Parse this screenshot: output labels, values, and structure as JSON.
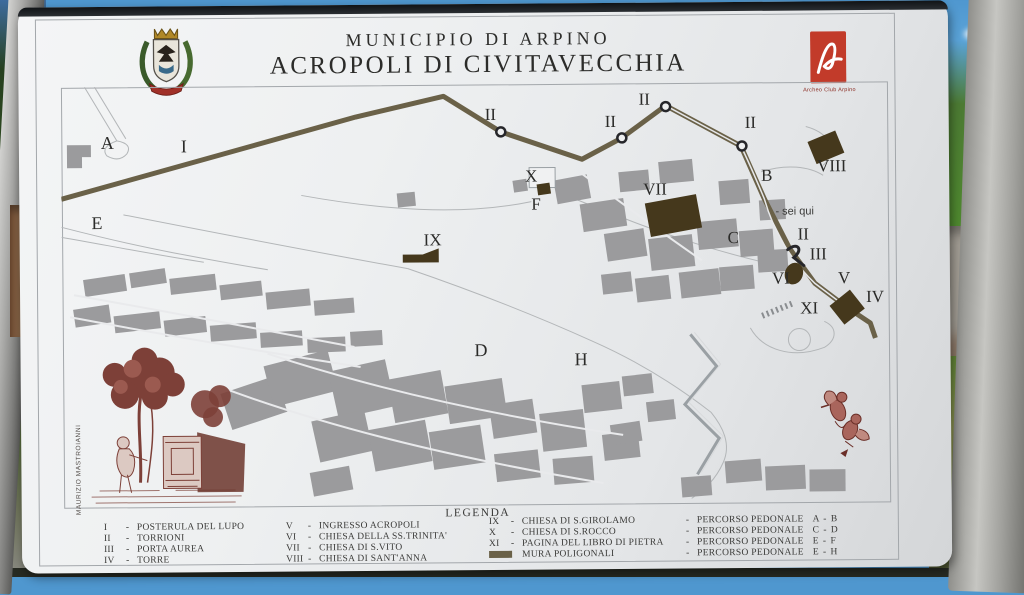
{
  "sign": {
    "title_line1": "MUNICIPIO DI ARPINO",
    "title_line2": "ACROPOLI DI CIVITAVECCHIA",
    "logo_caption": "Archeo Club Arpino",
    "artist_credit": "MAURIZIO MASTROIANNI"
  },
  "map": {
    "labels": {
      "area_a": "A",
      "percorso_i": "I",
      "area_e": "E",
      "torrione_ii": "II",
      "chiesa_x": "X",
      "percorso_f": "F",
      "chiesa_vii": "VII",
      "percorso_b": "B",
      "chiesa_viii": "VIII",
      "sei_qui": "- sei qui",
      "area_c": "C",
      "porta_iii": "III",
      "chiesa_vi": "VI",
      "ingresso_v": "V",
      "torre_iv": "IV",
      "pagina_xi": "XI",
      "chiesa_ix": "IX",
      "area_d": "D",
      "area_h": "H"
    }
  },
  "legend": {
    "title": "LEGENDA",
    "dash": "-",
    "col1": [
      {
        "num": "I",
        "label": "POSTERULA DEL LUPO"
      },
      {
        "num": "II",
        "label": "TORRIONI"
      },
      {
        "num": "III",
        "label": "PORTA AUREA"
      },
      {
        "num": "IV",
        "label": "TORRE"
      }
    ],
    "col2": [
      {
        "num": "V",
        "label": "INGRESSO ACROPOLI"
      },
      {
        "num": "VI",
        "label": "CHIESA DELLA SS.TRINITA'"
      },
      {
        "num": "VII",
        "label": "CHIESA DI S.VITO"
      },
      {
        "num": "VIII",
        "label": "CHIESA DI SANT'ANNA"
      }
    ],
    "col3": [
      {
        "num": "IX",
        "label": "CHIESA DI S.GIROLAMO"
      },
      {
        "num": "X",
        "label": "CHIESA DI S.ROCCO"
      },
      {
        "num": "XI",
        "label": "PAGINA DEL LIBRO DI PIETRA"
      },
      {
        "num": "",
        "label": "MURA POLIGONALI"
      }
    ],
    "col4": [
      {
        "label": "PERCORSO PEDONALE",
        "route": "A - B"
      },
      {
        "label": "PERCORSO PEDONALE",
        "route": "C - D"
      },
      {
        "label": "PERCORSO PEDONALE",
        "route": "E - F"
      },
      {
        "label": "PERCORSO PEDONALE",
        "route": "E - H"
      }
    ]
  },
  "colors": {
    "logo_red": "#c23b2a",
    "building_gray": "#9b9b9d",
    "wall_dark": "#6a6148",
    "church_brown": "#45381c",
    "engraving_maroon": "#7d4038"
  }
}
